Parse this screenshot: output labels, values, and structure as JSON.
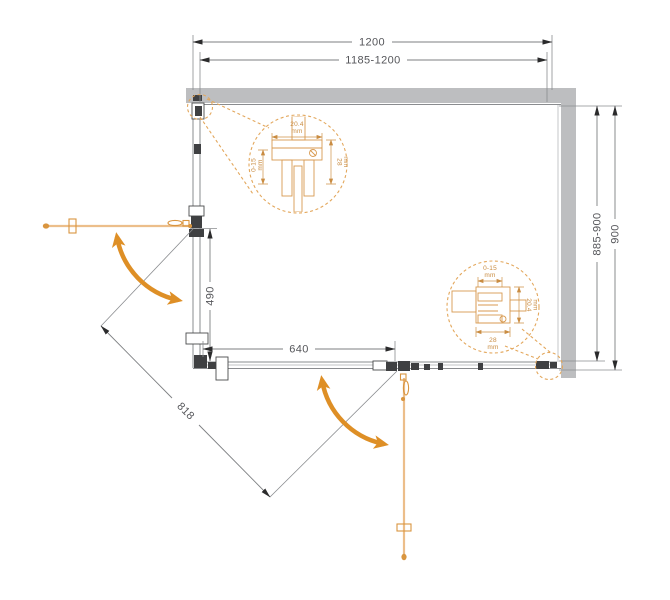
{
  "drawing_title": "corner shower enclosure plan view",
  "dims": {
    "top_outer": "1200",
    "top_inner": "1185-1200",
    "side_outer": "900",
    "side_inner": "885-900",
    "left_door": "490",
    "bottom_door": "640",
    "diagonal": "818"
  },
  "details": {
    "left": {
      "width": "20.4",
      "width_unit": "mm",
      "adjust": "0-15",
      "adjust_unit": "mm",
      "depth": "28",
      "depth_unit": "mm"
    },
    "right": {
      "adjust": "0-15",
      "adjust_unit": "mm",
      "depth": "28",
      "depth_unit": "mm",
      "width": "20.4",
      "width_unit": "mm"
    }
  },
  "colors": {
    "wall": "#BDBEC0",
    "frame": "#8A8C8F",
    "hardware": "#3F4042",
    "dimension_line": "#7D7F82",
    "text": "#55565A",
    "accent_orange": "#DE8F26",
    "door_glass": "#ECBE8A",
    "door_hardware": "#D9953F",
    "detail_orange": "#D89A50"
  }
}
